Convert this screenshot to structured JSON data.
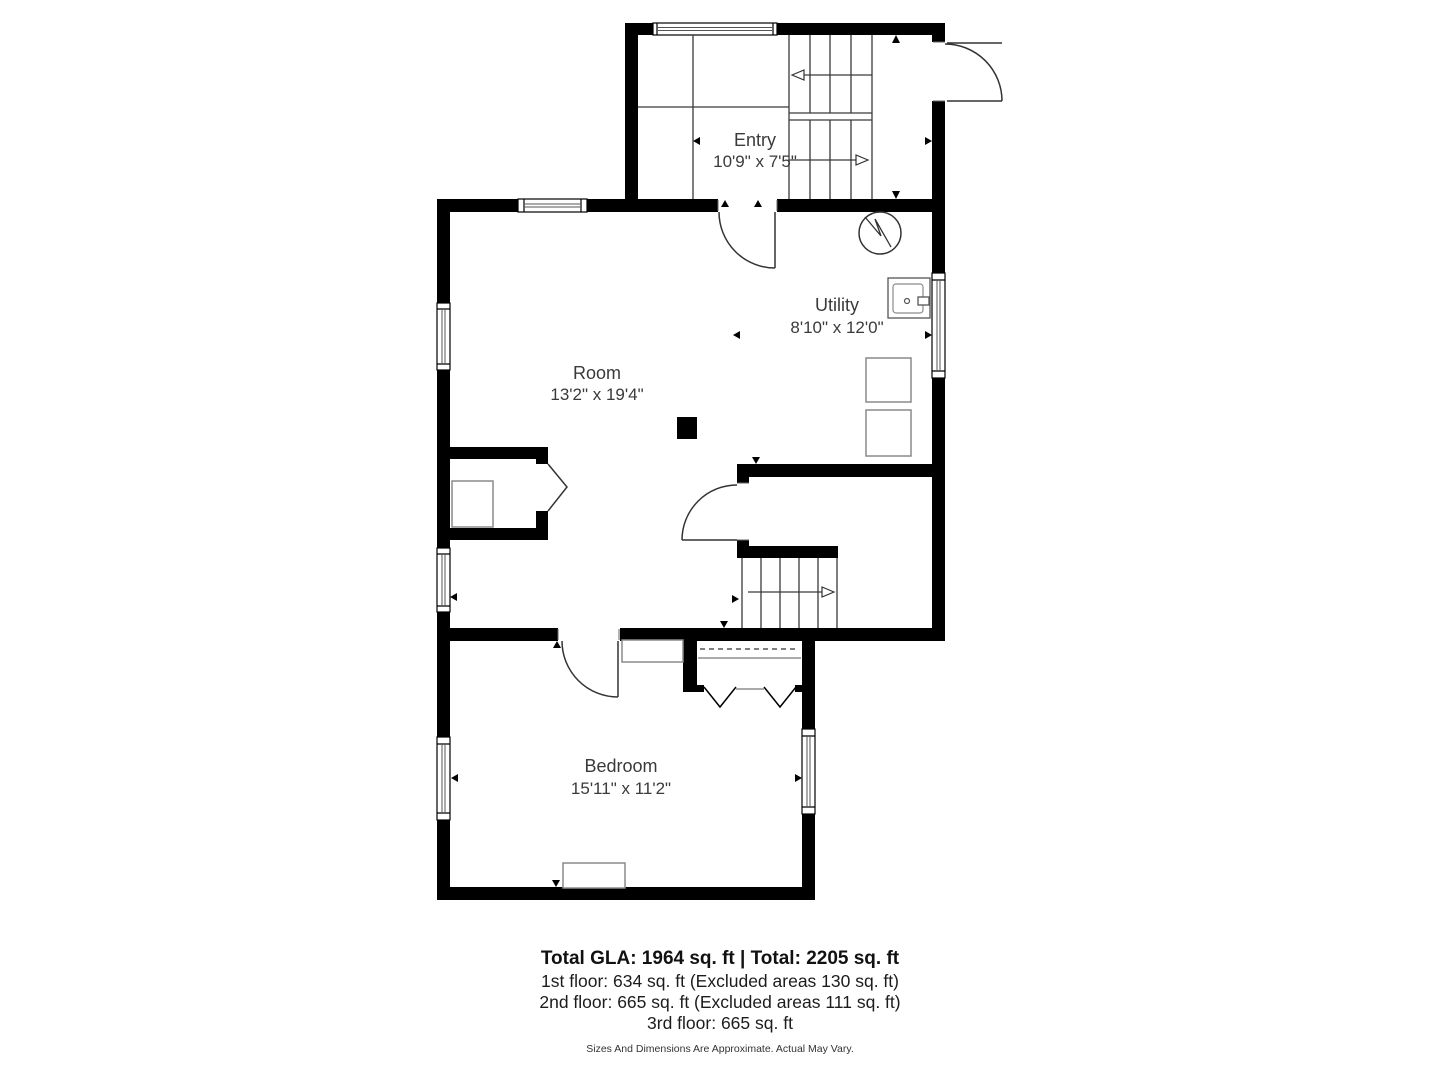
{
  "plan": {
    "rooms": [
      {
        "name": "Entry",
        "dims": "10'9\" x 7'5\""
      },
      {
        "name": "Utility",
        "dims": "8'10\" x 12'0\""
      },
      {
        "name": "Room",
        "dims": "13'2\" x 19'4\""
      },
      {
        "name": "Bedroom",
        "dims": "15'11\" x 11'2\""
      }
    ],
    "fixtures": [
      "staircase-switchback",
      "staircase-basement",
      "water-heater-icon",
      "utility-sink-icon",
      "washer-icon",
      "dryer-icon",
      "fireplace-icon",
      "support-column",
      "closet-bifold-doors",
      "closet-shelf",
      "dresser",
      "cabinet",
      "entry-exterior-door",
      "interior-doors",
      "windows",
      "dimension-markers"
    ],
    "colors": {
      "wall": "#000000",
      "line": "#3a3a3a",
      "furniture_outline": "#8a8a8a",
      "room_text": "#3a3a3a",
      "summary_text": "#111111",
      "background": "#ffffff"
    }
  },
  "summary": {
    "title": "Total GLA: 1964 sq. ft | Total: 2205 sq. ft",
    "floor1": "1st floor: 634 sq. ft (Excluded areas 130 sq. ft)",
    "floor2": "2nd floor: 665 sq. ft (Excluded areas 111 sq. ft)",
    "floor3": "3rd floor: 665 sq. ft",
    "disclaimer": "Sizes And Dimensions Are Approximate. Actual May Vary."
  }
}
